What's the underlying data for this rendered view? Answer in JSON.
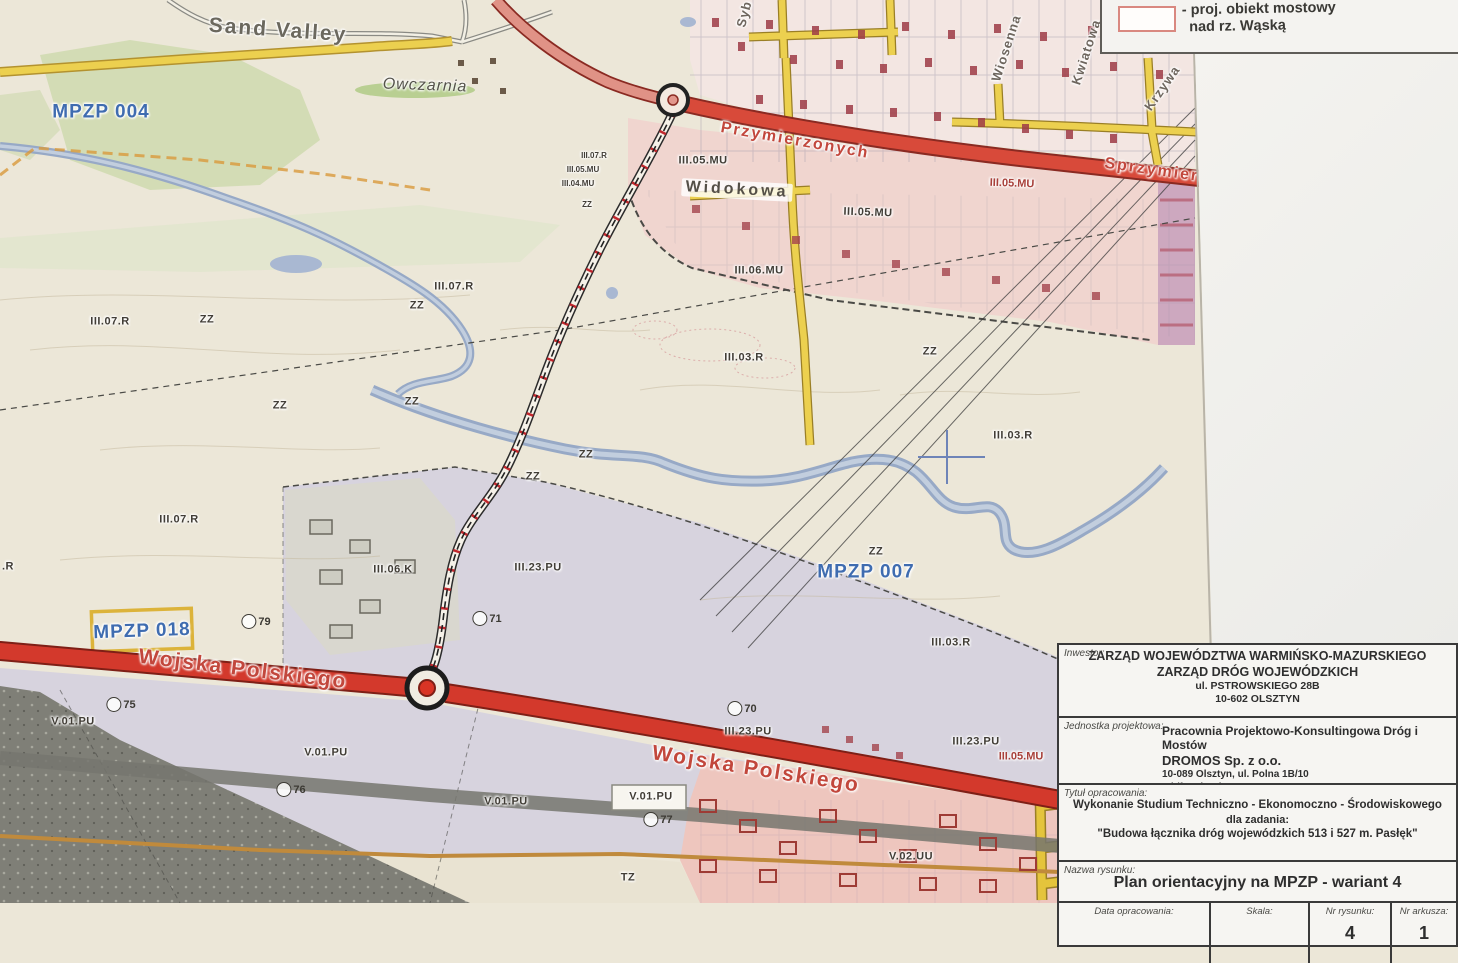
{
  "legend": {
    "bridge_item_line1": "- proj. obiekt mostowy",
    "bridge_item_line2": "nad rz. Wąską"
  },
  "map": {
    "labels": [
      {
        "t": "Sand Valley",
        "x": 278,
        "y": 30,
        "r": 4,
        "c": "place"
      },
      {
        "t": "Owczarnia",
        "x": 425,
        "y": 86,
        "r": 2,
        "c": "owczarnia"
      },
      {
        "t": "MPZP 004",
        "x": 101,
        "y": 112,
        "r": 0,
        "c": "mpzp"
      },
      {
        "t": "MPZP 007",
        "x": 866,
        "y": 572,
        "r": 0,
        "c": "mpzp"
      },
      {
        "t": "MPZP 018",
        "x": 142,
        "y": 631,
        "r": -2,
        "c": "mpzp"
      },
      {
        "t": "Przymierzonych",
        "x": 795,
        "y": 141,
        "r": 10,
        "c": "street"
      },
      {
        "t": "Sprzymierzonych",
        "x": 1185,
        "y": 175,
        "r": 8,
        "c": "street"
      },
      {
        "t": "Widokowa",
        "x": 737,
        "y": 190,
        "r": 3,
        "c": "street-dark"
      },
      {
        "t": "Wojska Polskiego",
        "x": 243,
        "y": 669,
        "r": 7,
        "c": "street-lg"
      },
      {
        "t": "Wojska Polskiego",
        "x": 756,
        "y": 769,
        "r": 9,
        "c": "street-lg"
      },
      {
        "t": "Wiosenna",
        "x": 1006,
        "y": 48,
        "r": -72,
        "c": "street-v"
      },
      {
        "t": "Kwiatowa",
        "x": 1086,
        "y": 52,
        "r": -72,
        "c": "street-v"
      },
      {
        "t": "Krzywa",
        "x": 1162,
        "y": 88,
        "r": -55,
        "c": "street-v"
      },
      {
        "t": "Syb",
        "x": 744,
        "y": 14,
        "r": -75,
        "c": "street-v"
      },
      {
        "t": "III.07.R",
        "x": 594,
        "y": 156,
        "r": 0,
        "c": "zone-sm"
      },
      {
        "t": "III.05.MU",
        "x": 583,
        "y": 170,
        "r": 0,
        "c": "zone-sm"
      },
      {
        "t": "III.04.MU",
        "x": 578,
        "y": 184,
        "r": 0,
        "c": "zone-sm"
      },
      {
        "t": "ZZ",
        "x": 587,
        "y": 205,
        "r": 0,
        "c": "zone-sm"
      },
      {
        "t": "III.05.MU",
        "x": 703,
        "y": 161,
        "r": 0,
        "c": "zone"
      },
      {
        "t": "III.05.MU",
        "x": 868,
        "y": 213,
        "r": 2,
        "c": "zone"
      },
      {
        "t": "III.05.MU",
        "x": 1012,
        "y": 184,
        "r": 2,
        "c": "zone-red"
      },
      {
        "t": "III.06.MU",
        "x": 759,
        "y": 271,
        "r": 0,
        "c": "zone"
      },
      {
        "t": "III.07.R",
        "x": 110,
        "y": 322,
        "r": 0,
        "c": "zone"
      },
      {
        "t": "III.07.R",
        "x": 454,
        "y": 287,
        "r": 0,
        "c": "zone"
      },
      {
        "t": "III.07.R",
        "x": 179,
        "y": 520,
        "r": 0,
        "c": "zone"
      },
      {
        "t": "III.03.R",
        "x": 744,
        "y": 358,
        "r": 0,
        "c": "zone"
      },
      {
        "t": "III.03.R",
        "x": 1013,
        "y": 436,
        "r": 0,
        "c": "zone"
      },
      {
        "t": "III.03.R",
        "x": 951,
        "y": 643,
        "r": 0,
        "c": "zone"
      },
      {
        "t": "III.06.K",
        "x": 393,
        "y": 570,
        "r": 0,
        "c": "zone"
      },
      {
        "t": "III.23.PU",
        "x": 538,
        "y": 568,
        "r": 0,
        "c": "zone"
      },
      {
        "t": "III.23.PU",
        "x": 748,
        "y": 732,
        "r": 0,
        "c": "zone"
      },
      {
        "t": "III.23.PU",
        "x": 976,
        "y": 742,
        "r": 0,
        "c": "zone"
      },
      {
        "t": "III.05.MU",
        "x": 1021,
        "y": 757,
        "r": 0,
        "c": "zone-red"
      },
      {
        "t": "V.01.PU",
        "x": 73,
        "y": 722,
        "r": 0,
        "c": "zone"
      },
      {
        "t": "V.01.PU",
        "x": 326,
        "y": 753,
        "r": 0,
        "c": "zone"
      },
      {
        "t": "V.01.PU",
        "x": 506,
        "y": 802,
        "r": 0,
        "c": "zone"
      },
      {
        "t": "V.01.PU",
        "x": 651,
        "y": 797,
        "r": 0,
        "c": "zone"
      },
      {
        "t": "V.02.UU",
        "x": 911,
        "y": 857,
        "r": 0,
        "c": "zone"
      },
      {
        "t": "TZ",
        "x": 628,
        "y": 878,
        "r": 0,
        "c": "zone"
      },
      {
        "t": "ZZ",
        "x": 207,
        "y": 320,
        "r": 0,
        "c": "zone"
      },
      {
        "t": "ZZ",
        "x": 417,
        "y": 306,
        "r": 0,
        "c": "zone"
      },
      {
        "t": "ZZ",
        "x": 280,
        "y": 406,
        "r": 0,
        "c": "zone"
      },
      {
        "t": "ZZ",
        "x": 412,
        "y": 402,
        "r": 0,
        "c": "zone"
      },
      {
        "t": "ZZ",
        "x": 533,
        "y": 477,
        "r": 0,
        "c": "zone"
      },
      {
        "t": "ZZ",
        "x": 586,
        "y": 455,
        "r": 0,
        "c": "zone"
      },
      {
        "t": "ZZ",
        "x": 930,
        "y": 352,
        "r": 0,
        "c": "zone"
      },
      {
        "t": "ZZ",
        "x": 876,
        "y": 552,
        "r": 0,
        "c": "zone"
      },
      {
        "t": ".R",
        "x": 8,
        "y": 567,
        "r": 0,
        "c": "zone"
      }
    ],
    "markers": [
      {
        "n": "79",
        "x": 255,
        "y": 624
      },
      {
        "n": "75",
        "x": 120,
        "y": 707
      },
      {
        "n": "76",
        "x": 290,
        "y": 792
      },
      {
        "n": "71",
        "x": 486,
        "y": 621
      },
      {
        "n": "77",
        "x": 657,
        "y": 822
      },
      {
        "n": "70",
        "x": 741,
        "y": 711
      }
    ]
  },
  "title_block": {
    "investor": {
      "label": "Inwestor:",
      "line1": "ZARZĄD WOJEWÓDZTWA WARMIŃSKO-MAZURSKIEGO",
      "line2": "ZARZĄD DRÓG WOJEWÓDZKICH",
      "line3": "ul. PSTROWSKIEGO 28B",
      "line4": "10-602 OLSZTYN"
    },
    "design_unit": {
      "label": "Jednostka projektowa:",
      "line1": "Pracownia Projektowo-Konsultingowa Dróg i Mostów",
      "line2": "DROMOS Sp. z o.o.",
      "line3": "10-089 Olsztyn, ul. Polna 1B/10",
      "line4": "tel./fax. (089) 534 94 20"
    },
    "study_title": {
      "label": "Tytuł opracowania:",
      "line1": "Wykonanie Studium Techniczno - Ekonomoczno - Środowiskowego",
      "line2": "dla zadania:",
      "line3": "\"Budowa łącznika dróg wojewódzkich 513 i 527 m. Pasłęk\""
    },
    "drawing_name": {
      "label": "Nazwa rysunku:",
      "value": "Plan orientacyjny na MPZP - wariant 4"
    },
    "footer": {
      "date_label": "Data opracowania:",
      "scale_label": "Skala:",
      "drawing_no_label": "Nr rysunku:",
      "drawing_no": "4",
      "sheet_label": "Nr arkusza:",
      "sheet_no": "1"
    }
  },
  "colors": {
    "road_red": "#d3392c",
    "road_yellow": "#e9c83d",
    "water_blue": "#97a9c6",
    "mpzp_blue": "#3f6cb0",
    "street_label_red": "#c2473c"
  }
}
